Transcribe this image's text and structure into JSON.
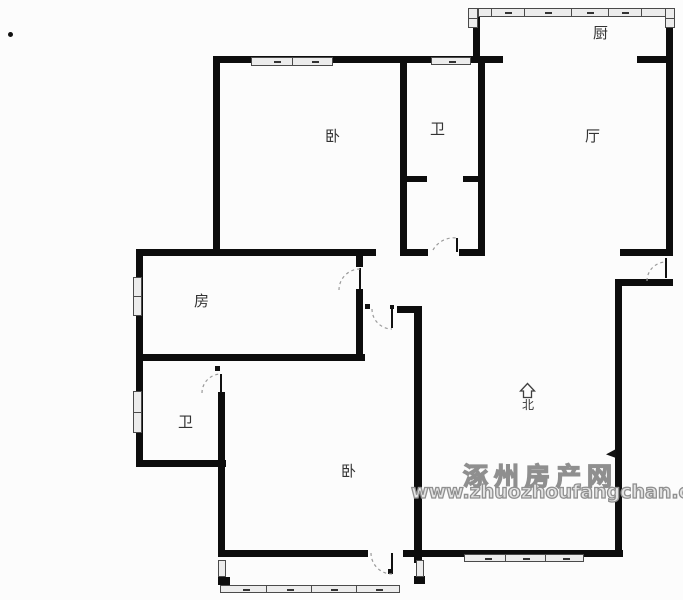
{
  "plan_title": "apartment-floor-plan",
  "rooms": {
    "kitchen": {
      "label": "厨"
    },
    "living": {
      "label": "厅"
    },
    "bath_top": {
      "label": "卫"
    },
    "bedroom_top": {
      "label": "卧"
    },
    "room_mid": {
      "label": "房"
    },
    "bath_ensuite": {
      "label": "卫"
    },
    "bedroom_bottom": {
      "label": "卧"
    }
  },
  "compass": {
    "north_label": "北"
  },
  "watermark": {
    "site_name": "涿州房产网",
    "site_url": "www.zhuozhoufangchan.com"
  },
  "colors": {
    "wall": "#0d0d0d",
    "background": "#fcfcfc",
    "window_fill": "#ececec",
    "window_line": "#4a4a4a",
    "door_arc": "#9a9a9a",
    "watermark_gray": "#8f8f8f"
  }
}
